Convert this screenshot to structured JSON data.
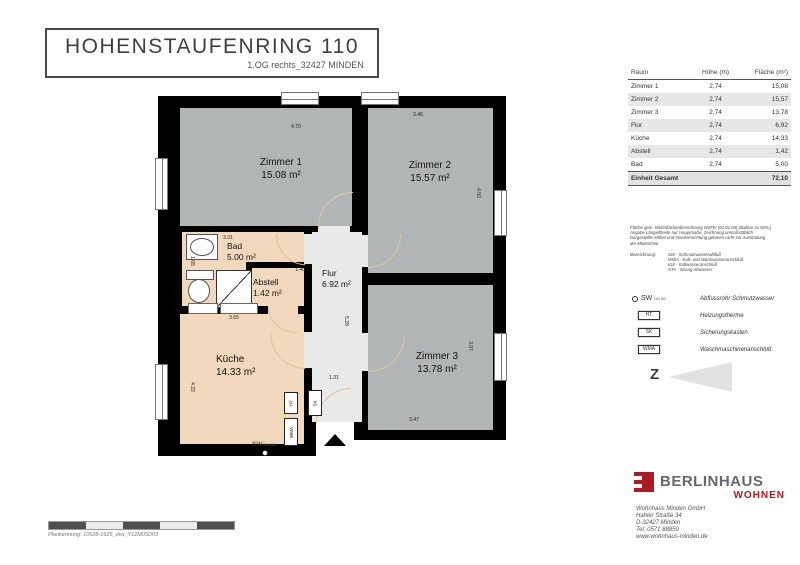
{
  "title_block": {
    "title": "HOHENSTAUFENRING 110",
    "subtitle": "1.OG rechts_32427 MINDEN"
  },
  "room_table": {
    "headers": [
      "Raum",
      "Höhe (m)",
      "Fläche (m²)"
    ],
    "rows": [
      {
        "raum": "Zimmer 1",
        "hoehe": "2,74",
        "flaeche": "15,08"
      },
      {
        "raum": "Zimmer 2",
        "hoehe": "2,74",
        "flaeche": "15,57"
      },
      {
        "raum": "Zimmer 3",
        "hoehe": "2,74",
        "flaeche": "13,78"
      },
      {
        "raum": "Flur",
        "hoehe": "2,74",
        "flaeche": "6,92"
      },
      {
        "raum": "Küche",
        "hoehe": "2,74",
        "flaeche": "14,33"
      },
      {
        "raum": "Abstell",
        "hoehe": "2,74",
        "flaeche": "1,42"
      },
      {
        "raum": "Bad",
        "hoehe": "2,74",
        "flaeche": "5,00"
      }
    ],
    "footer": {
      "label": "Einheit Gesamt",
      "value": "72,10"
    }
  },
  "notes": {
    "lines": [
      "Fläche gem. Wohnflächenberechnung WoFlV (01.01.04) (Balkon zu 50%,)",
      "Angabe Länge/Breite nur Hauptmaße, Zeichnung unmaßstäblich",
      "Dargestellte Möbel und Inneneinrichtung gehören nicht zur Ausstattung",
      "der Mieteinheit"
    ],
    "bezeichnung_label": "Bezeichnung:",
    "bezeichnung_items": [
      "SW - Schmutzwasserabfluß",
      "WWA - Kalt- und Warmwasseranschluß",
      "KW - Kaltwasseranschluß",
      "STA - Strang Abwasser"
    ]
  },
  "legend": {
    "items": [
      {
        "symbol": "SW",
        "symbol_suffix": "DN 50",
        "label": "Abflussrohr Schmutzwasser"
      },
      {
        "symbol": "HT",
        "label": "Heizungstherme"
      },
      {
        "symbol": "SK",
        "label": "Sicherungskasten"
      },
      {
        "symbol": "WMA",
        "label": "Waschmaschinenanschluß"
      }
    ]
  },
  "north_arrow": {
    "letter": "Z"
  },
  "brand": {
    "name": "BERLINHAUS",
    "division": "WOHNEN",
    "address_lines": [
      "Wohnhaus Minden GmbH",
      "Hahler Straße 34",
      "D-32427 Minden",
      "Tel: 0571 88850",
      "www.wohnhaus-minden.de"
    ]
  },
  "plan_footer": {
    "plan_id": "Plankennung: 10528-1625_dva_Y12M05D03"
  },
  "floor_plan": {
    "rooms": [
      {
        "name": "Zimmer 1",
        "area": "15.08 m²"
      },
      {
        "name": "Zimmer 2",
        "area": "15.57 m²"
      },
      {
        "name": "Zimmer 3",
        "area": "13.78 m²"
      },
      {
        "name": "Bad",
        "area": "5.00 m²"
      },
      {
        "name": "Abstell",
        "area": "1.42 m²"
      },
      {
        "name": "Flur",
        "area": "6.92 m²"
      },
      {
        "name": "Küche",
        "area": "14.33 m²"
      }
    ],
    "dims": [
      "4.70",
      "3.46",
      "4.50",
      "3.31",
      "1.65",
      "1.46",
      "5.28",
      "1.31",
      "3.65",
      "4.22",
      "3.47",
      "3.97"
    ],
    "equipment": {
      "ht": "HT",
      "sk": "SK",
      "wma": "WMA",
      "sw": "SW",
      "sw_size": "DN 50"
    }
  },
  "colors": {
    "brand_red": "#ad1a22",
    "room_gray": "#b2b5b6",
    "room_beige": "#f2d8bc",
    "hall_gray": "#e9e9e7"
  }
}
